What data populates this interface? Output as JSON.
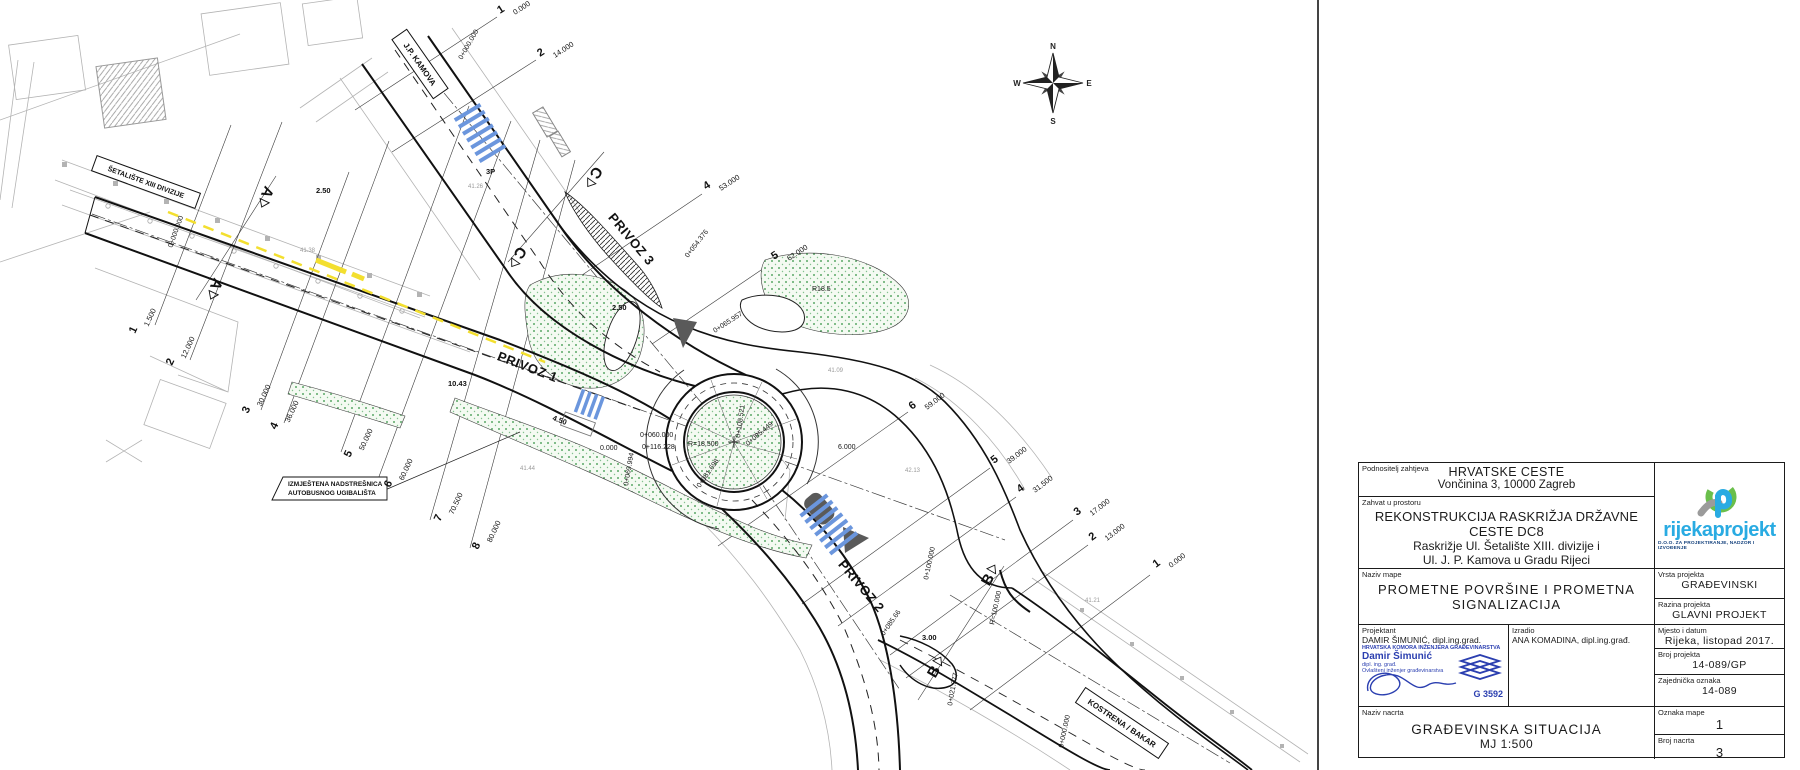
{
  "title_block": {
    "podnositelj": {
      "label": "Podnositelj zahtjeva",
      "line1": "HRVATSKE CESTE",
      "line2": "Vončinina 3, 10000 Zagreb"
    },
    "zahvat": {
      "label": "Zahvat u prostoru",
      "line1": "REKONSTRUKCIJA RASKRIŽJA  DRŽAVNE CESTE DC8",
      "line2": "Raskrižje Ul. Šetalište XIII. divizije i",
      "line3": "Ul. J. P. Kamova u Gradu Rijeci"
    },
    "naziv_mape": {
      "label": "Naziv mape",
      "line1": "PROMETNE POVRŠINE I PROMETNA",
      "line2": "SIGNALIZACIJA"
    },
    "projektant": {
      "label": "Projektant",
      "name": "DAMIR ŠIMUNIĆ, dipl.ing.grad."
    },
    "stamp": {
      "chamber": "HRVATSKA KOMORA INŽENJERA GRAĐEVINARSTVA",
      "name": "Damir Šimunić",
      "title": "dipl. ing. građ.",
      "role": "Ovlašteni inženjer građevinarstva",
      "number": "G 3592"
    },
    "izradio": {
      "label": "Izradio",
      "name": "ANA KOMADINA, dipl.ing.građ."
    },
    "naziv_nacrta": {
      "label": "Naziv nacrta",
      "line1": "GRAĐEVINSKA SITUACIJA",
      "line2": "MJ 1:500"
    },
    "logo": {
      "wordmark": "rijekaprojekt",
      "tagline": "D.O.O. ZA PROJEKTIRANJE, NADZOR I IZVOĐENJE"
    },
    "vrsta": {
      "label": "Vrsta projekta",
      "value": "GRAĐEVINSKI"
    },
    "razina": {
      "label": "Razina projekta",
      "value": "GLAVNI PROJEKT"
    },
    "mjesto": {
      "label": "Mjesto i datum",
      "value": "Rijeka, listopad 2017."
    },
    "broj_projekta": {
      "label": "Broj projekta",
      "value": "14-089/GP"
    },
    "zajednicka": {
      "label": "Zajednička oznaka",
      "value": "14-089"
    },
    "oznaka_mape": {
      "label": "Oznaka mape",
      "value": "1"
    },
    "broj_nacrta": {
      "label": "Broj nacrta",
      "value": "3"
    }
  },
  "drawing": {
    "compass": {
      "n": "N",
      "e": "E",
      "s": "S",
      "w": "W"
    },
    "roads": {
      "privoz1": "PRIVOZ 1",
      "privoz2": "PRIVOZ 2",
      "privoz3": "PRIVOZ 3",
      "jp_kamova": "J.P. KAMOVA",
      "setaliste": "ŠETALIŠTE XIII DIVIZIJE",
      "kostrena": "KOSTRENA / BAKAR"
    },
    "note": {
      "line1": "IZMJEŠTENA NADSTREŠNICA",
      "line2": "AUTOBUSNOG UGIBALIŠTA"
    },
    "section_letters": {
      "a": "A",
      "b": "B",
      "c": "C"
    },
    "cross_sections": {
      "privoz1": [
        {
          "no": "1",
          "ch": "1.500"
        },
        {
          "no": "2",
          "ch": "12.000"
        },
        {
          "no": "3",
          "ch": "30.000"
        },
        {
          "no": "4",
          "ch": "36.000"
        },
        {
          "no": "5",
          "ch": "50.000"
        },
        {
          "no": "6",
          "ch": "60.000"
        },
        {
          "no": "7",
          "ch": "70.500"
        },
        {
          "no": "8",
          "ch": "80.000"
        }
      ],
      "privoz2": [
        {
          "no": "6",
          "ch": "59.000"
        },
        {
          "no": "5",
          "ch": "39.000"
        },
        {
          "no": "4",
          "ch": "31.500"
        },
        {
          "no": "3",
          "ch": "17.000"
        },
        {
          "no": "2",
          "ch": "13.000"
        },
        {
          "no": "1",
          "ch": "0.000"
        }
      ],
      "privoz3": [
        {
          "no": "1",
          "ch": "0.000"
        },
        {
          "no": "2",
          "ch": "14.000"
        },
        {
          "no": "4",
          "ch": "53.000"
        },
        {
          "no": "5",
          "ch": "62.000"
        }
      ]
    },
    "stations": [
      "0+000.000",
      "0+000.000",
      "0+054.376",
      "0+065.957",
      "0+060.000",
      "0+116.228",
      "0.000",
      "R=18.500",
      "0+108.521",
      "0+085.449",
      "0+081.698",
      "0+069.994",
      "R18.5",
      "0+100.000",
      "R=100.000",
      "0+085.66",
      "0+021.377",
      "0+000.000",
      "3.00",
      "4.50",
      "10.43",
      "6.000",
      "3P",
      "2.50",
      "2.50"
    ],
    "heights": [
      "41.26",
      "41.09",
      "41.38",
      "42.13",
      "41.44",
      "41.21"
    ]
  }
}
